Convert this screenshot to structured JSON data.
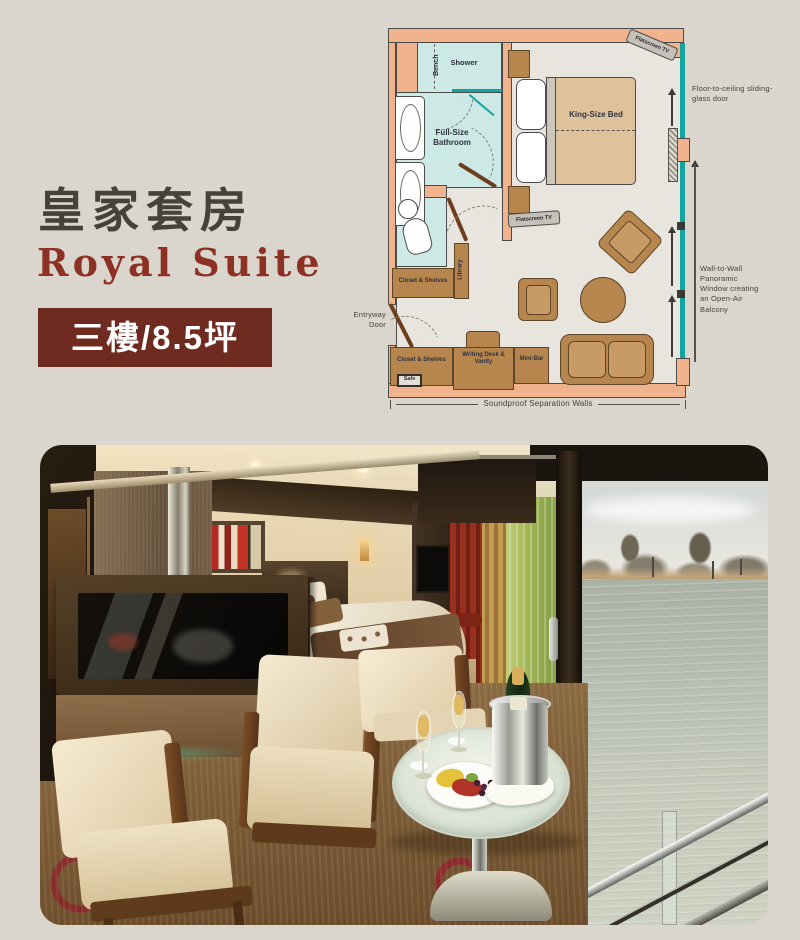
{
  "page": {
    "background": "#dad6cd"
  },
  "header": {
    "title_zh": "皇家套房",
    "title_en": "Royal Suite",
    "badge": "三樓/8.5坪",
    "title_color": "#46413a",
    "accent_color": "#8e3125",
    "badge_bg": "#6f2b20"
  },
  "floorplan": {
    "colors": {
      "wall": "#f1b28e",
      "floor": "#e8e5df",
      "wet_area": "#cde9e5",
      "glass": "#12a49e",
      "furniture": "#b7854e",
      "outline": "#4b4b47",
      "bed": "#dfc29b"
    },
    "labels": {
      "bench": "Bench",
      "shower": "Shower",
      "bathroom": "Full-Size Bathroom",
      "library": "Library",
      "closet_upper": "Closet & Shelves",
      "closet_lower": "Closet & Shelves",
      "safe": "Safe",
      "writing_desk": "Writing Desk & Vanity",
      "minibar": "Mini-Bar",
      "king_bed": "King-Size Bed",
      "tv_top": "Flatscreen TV",
      "tv_living": "Flatscreen TV"
    },
    "annotations": {
      "sliding_door": "Floor-to-ceiling sliding-glass door",
      "panoramic_window": "Wall-to-Wall Panoramic Window creating an Open-Air Balcony",
      "entryway": "Entryway Door",
      "soundproof": "Soundproof Separation Walls"
    }
  }
}
